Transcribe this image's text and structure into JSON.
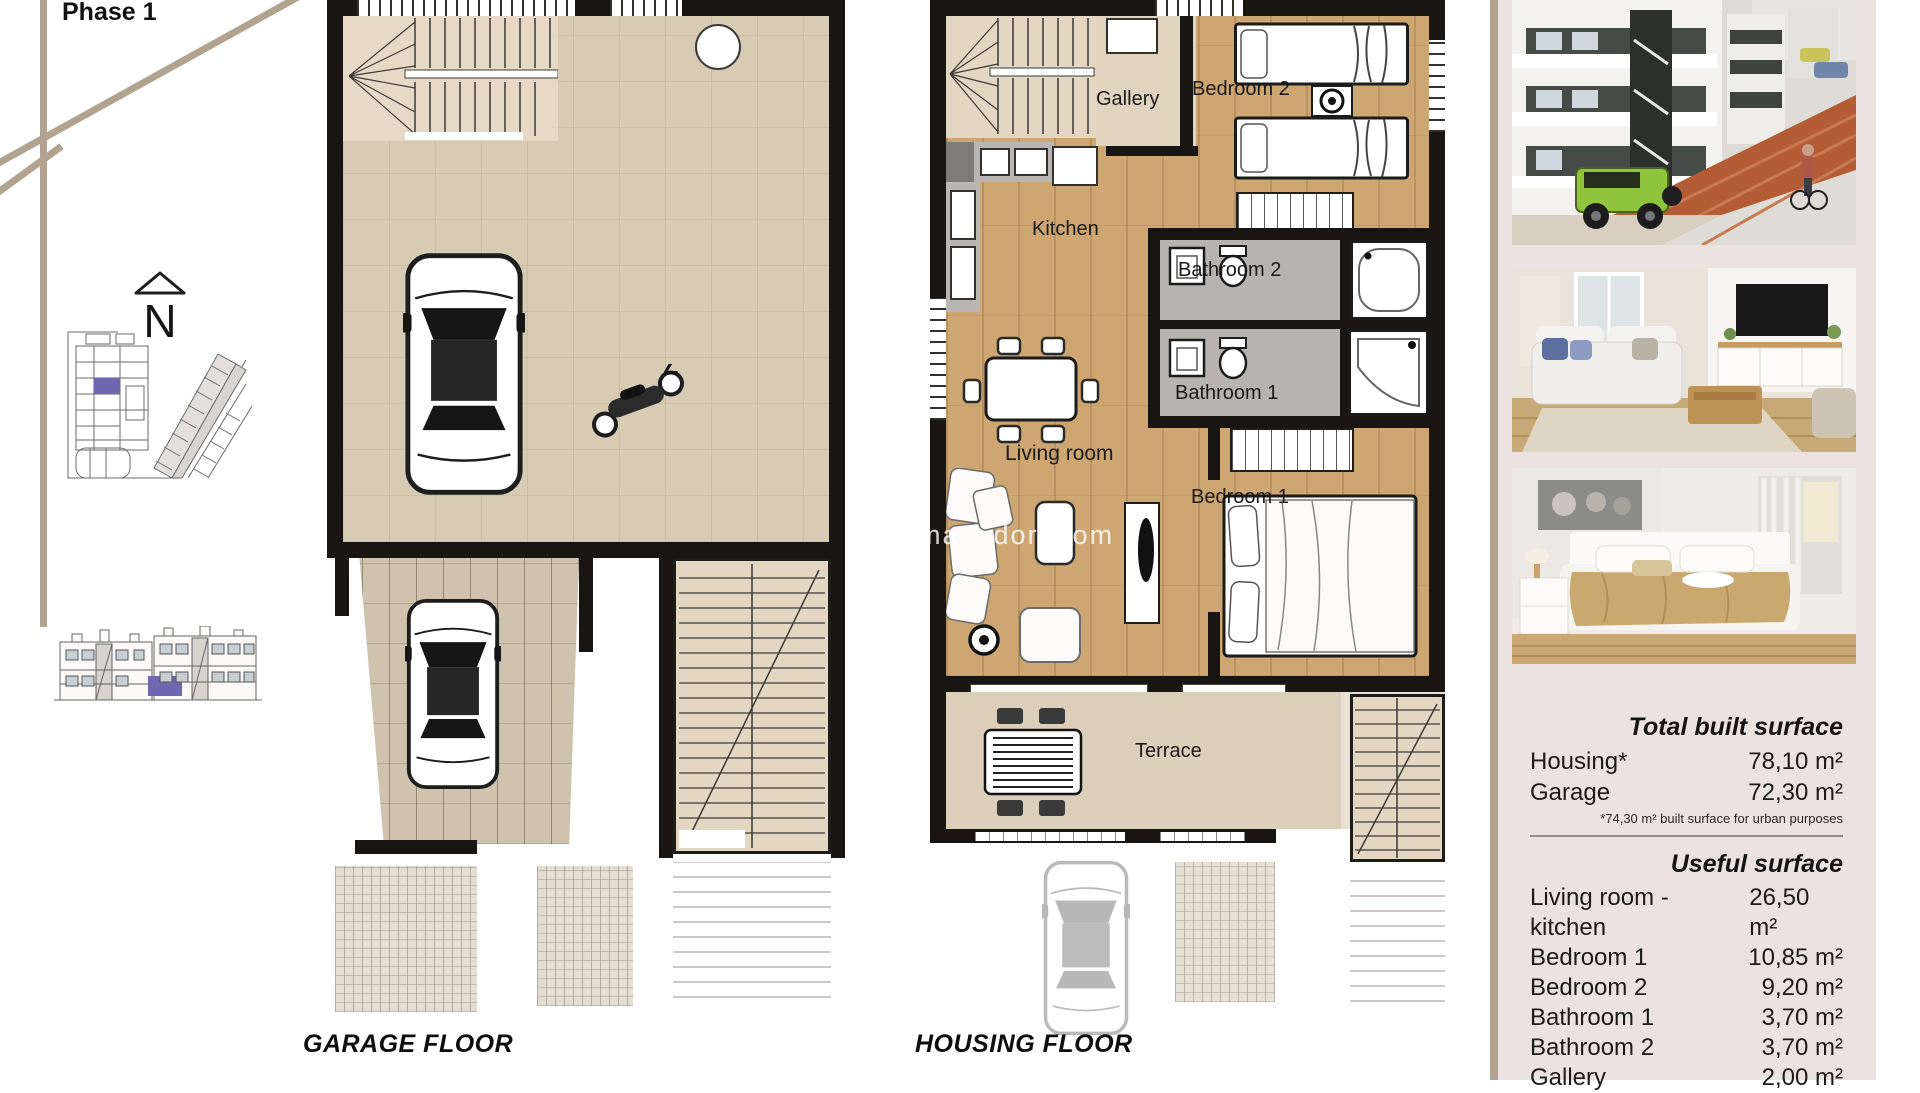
{
  "header": {
    "phase_label": "Phase 1"
  },
  "compass": {
    "letter": "N"
  },
  "plans": {
    "garage": {
      "title": "GARAGE FLOOR"
    },
    "housing": {
      "title": "HOUSING FLOOR",
      "rooms": {
        "gallery": "Gallery",
        "bedroom2": "Bedroom 2",
        "kitchen": "Kitchen",
        "bathroom2": "Bathroom 2",
        "bathroom1": "Bathroom 1",
        "living_room": "Living room",
        "bedroom1": "Bedroom 1",
        "terrace": "Terrace"
      }
    }
  },
  "watermark": {
    "f1": "ma",
    "f2": "dor",
    "f3": "om"
  },
  "sidebar": {
    "built": {
      "title": "Total built surface",
      "rows": [
        {
          "label": "Housing*",
          "value": "78,10 m²"
        },
        {
          "label": "Garage",
          "value": "72,30 m²"
        }
      ],
      "note": "*74,30 m² built surface for urban purposes"
    },
    "useful": {
      "title": "Useful surface",
      "rows": [
        {
          "label": "Living room - kitchen",
          "value": "26,50 m²"
        },
        {
          "label": "Bedroom 1",
          "value": "10,85 m²"
        },
        {
          "label": "Bedroom 2",
          "value": "9,20 m²"
        },
        {
          "label": "Bathroom 1",
          "value": "3,70 m²"
        },
        {
          "label": "Bathroom 2",
          "value": "3,70 m²"
        },
        {
          "label": "Gallery",
          "value": "2,00 m²"
        }
      ]
    }
  },
  "colors": {
    "accent_purple": "#6f68b0",
    "tan_line": "#b2a390",
    "panel_pink": "#ece2e0",
    "wall_black": "#181512"
  }
}
